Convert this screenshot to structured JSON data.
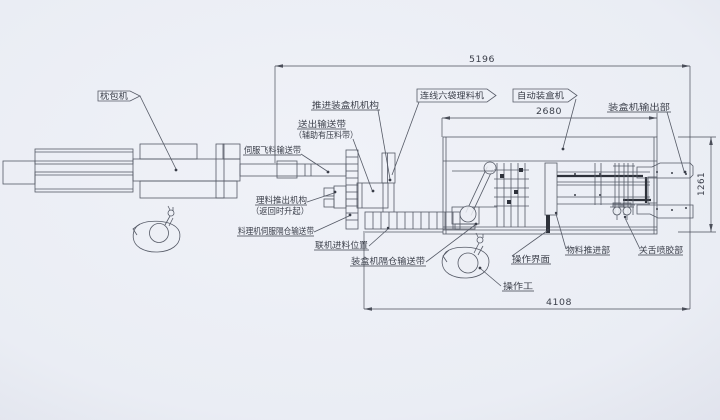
{
  "drawing": {
    "title_context": "packaging line layout drawing",
    "machines": {
      "pillow_packer": "枕包机",
      "inline_six_pocket_sorter": "连线六袋理料机",
      "auto_cartoner": "自动装盒机"
    },
    "labels": {
      "push_into_cartoner": "推进装盒机机构",
      "outfeed_belt": "送出输送带",
      "outfeed_belt_note": "（辅助有压料带）",
      "servo_fly_belt": "伺服飞料输送带",
      "sorter_pushout": "理料推出机构",
      "sorter_pushout_note": "（返回时升起）",
      "sorter_servo_compartment_belt": "料理机伺服隔仓输送带",
      "inline_feed_position": "联机进料位置",
      "cartoner_compartment_belt": "装盒机隔仓输送带",
      "hmi": "操作界面",
      "operator": "操作工",
      "material_pusher": "物料推进部",
      "tuck_glue": "关舌喷胶部",
      "cartoner_output": "装盒机输出部"
    },
    "dimensions": {
      "overall_length": "5196",
      "cartoner_length": "2680",
      "line_length": "4108",
      "output_height": "1261"
    },
    "colors": {
      "paper": "#eceef5",
      "paper_edge": "#e1e4ed",
      "line": "#555a66",
      "dark": "#2e323b",
      "text": "#3a3e49"
    }
  }
}
